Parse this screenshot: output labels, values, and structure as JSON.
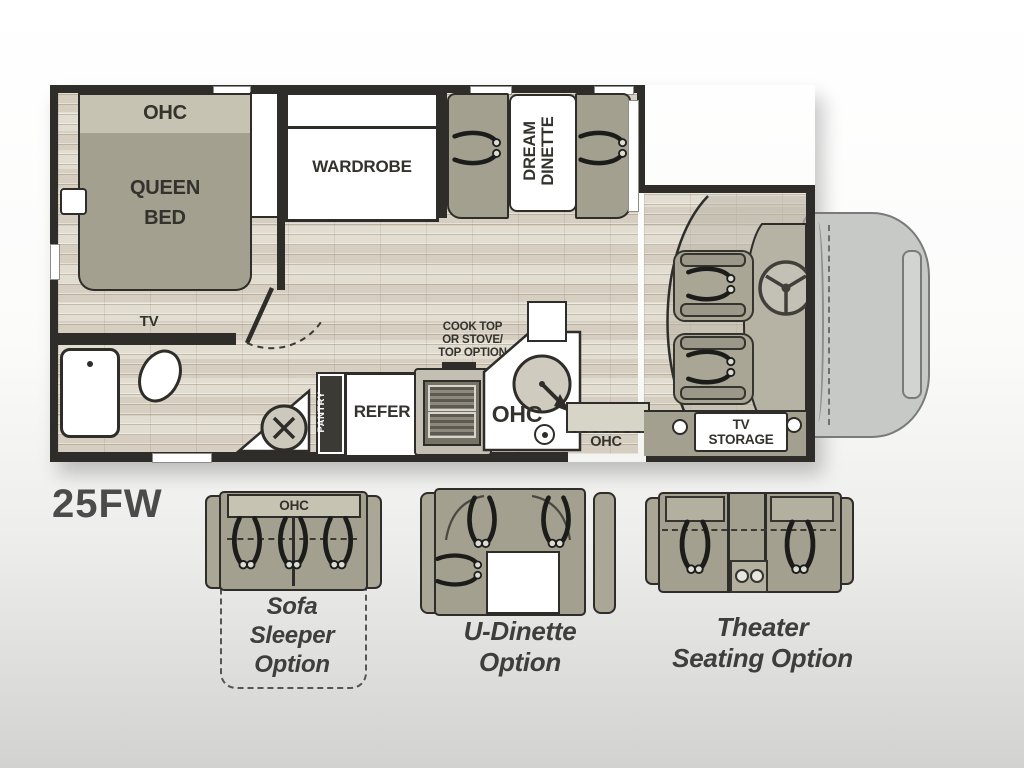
{
  "model_label": "25FW",
  "colors": {
    "wall": "#2e2d2a",
    "line": "#2e2d2a",
    "ink": "#33322d",
    "furniture": "#a3a08f",
    "furniture-light": "#c6c3b2",
    "floor": "#ddd7ca",
    "cab-gray": "#c7c9c7"
  },
  "plan": {
    "bedroom": {
      "ohc": "OHC",
      "bed": "QUEEN\nBED",
      "wardrobe": "WARDROBE",
      "tv": "TV"
    },
    "dinette": {
      "table": "DREAM\nDINETTE"
    },
    "kitchen": {
      "note": "COOK TOP\nOR STOVE/\nTOP OPTION",
      "pantry": "PANTRY",
      "refer": "REFER",
      "ohc": "OHC"
    },
    "entry": {
      "ohc": "OHC"
    },
    "cab": {
      "tv_storage": "TV\nSTORAGE"
    }
  },
  "options": {
    "sofa": {
      "ohc": "OHC",
      "label": "Sofa\nSleeper\nOption"
    },
    "u_dinette": {
      "label": "U-Dinette\nOption"
    },
    "theater": {
      "label": "Theater\nSeating Option"
    }
  }
}
